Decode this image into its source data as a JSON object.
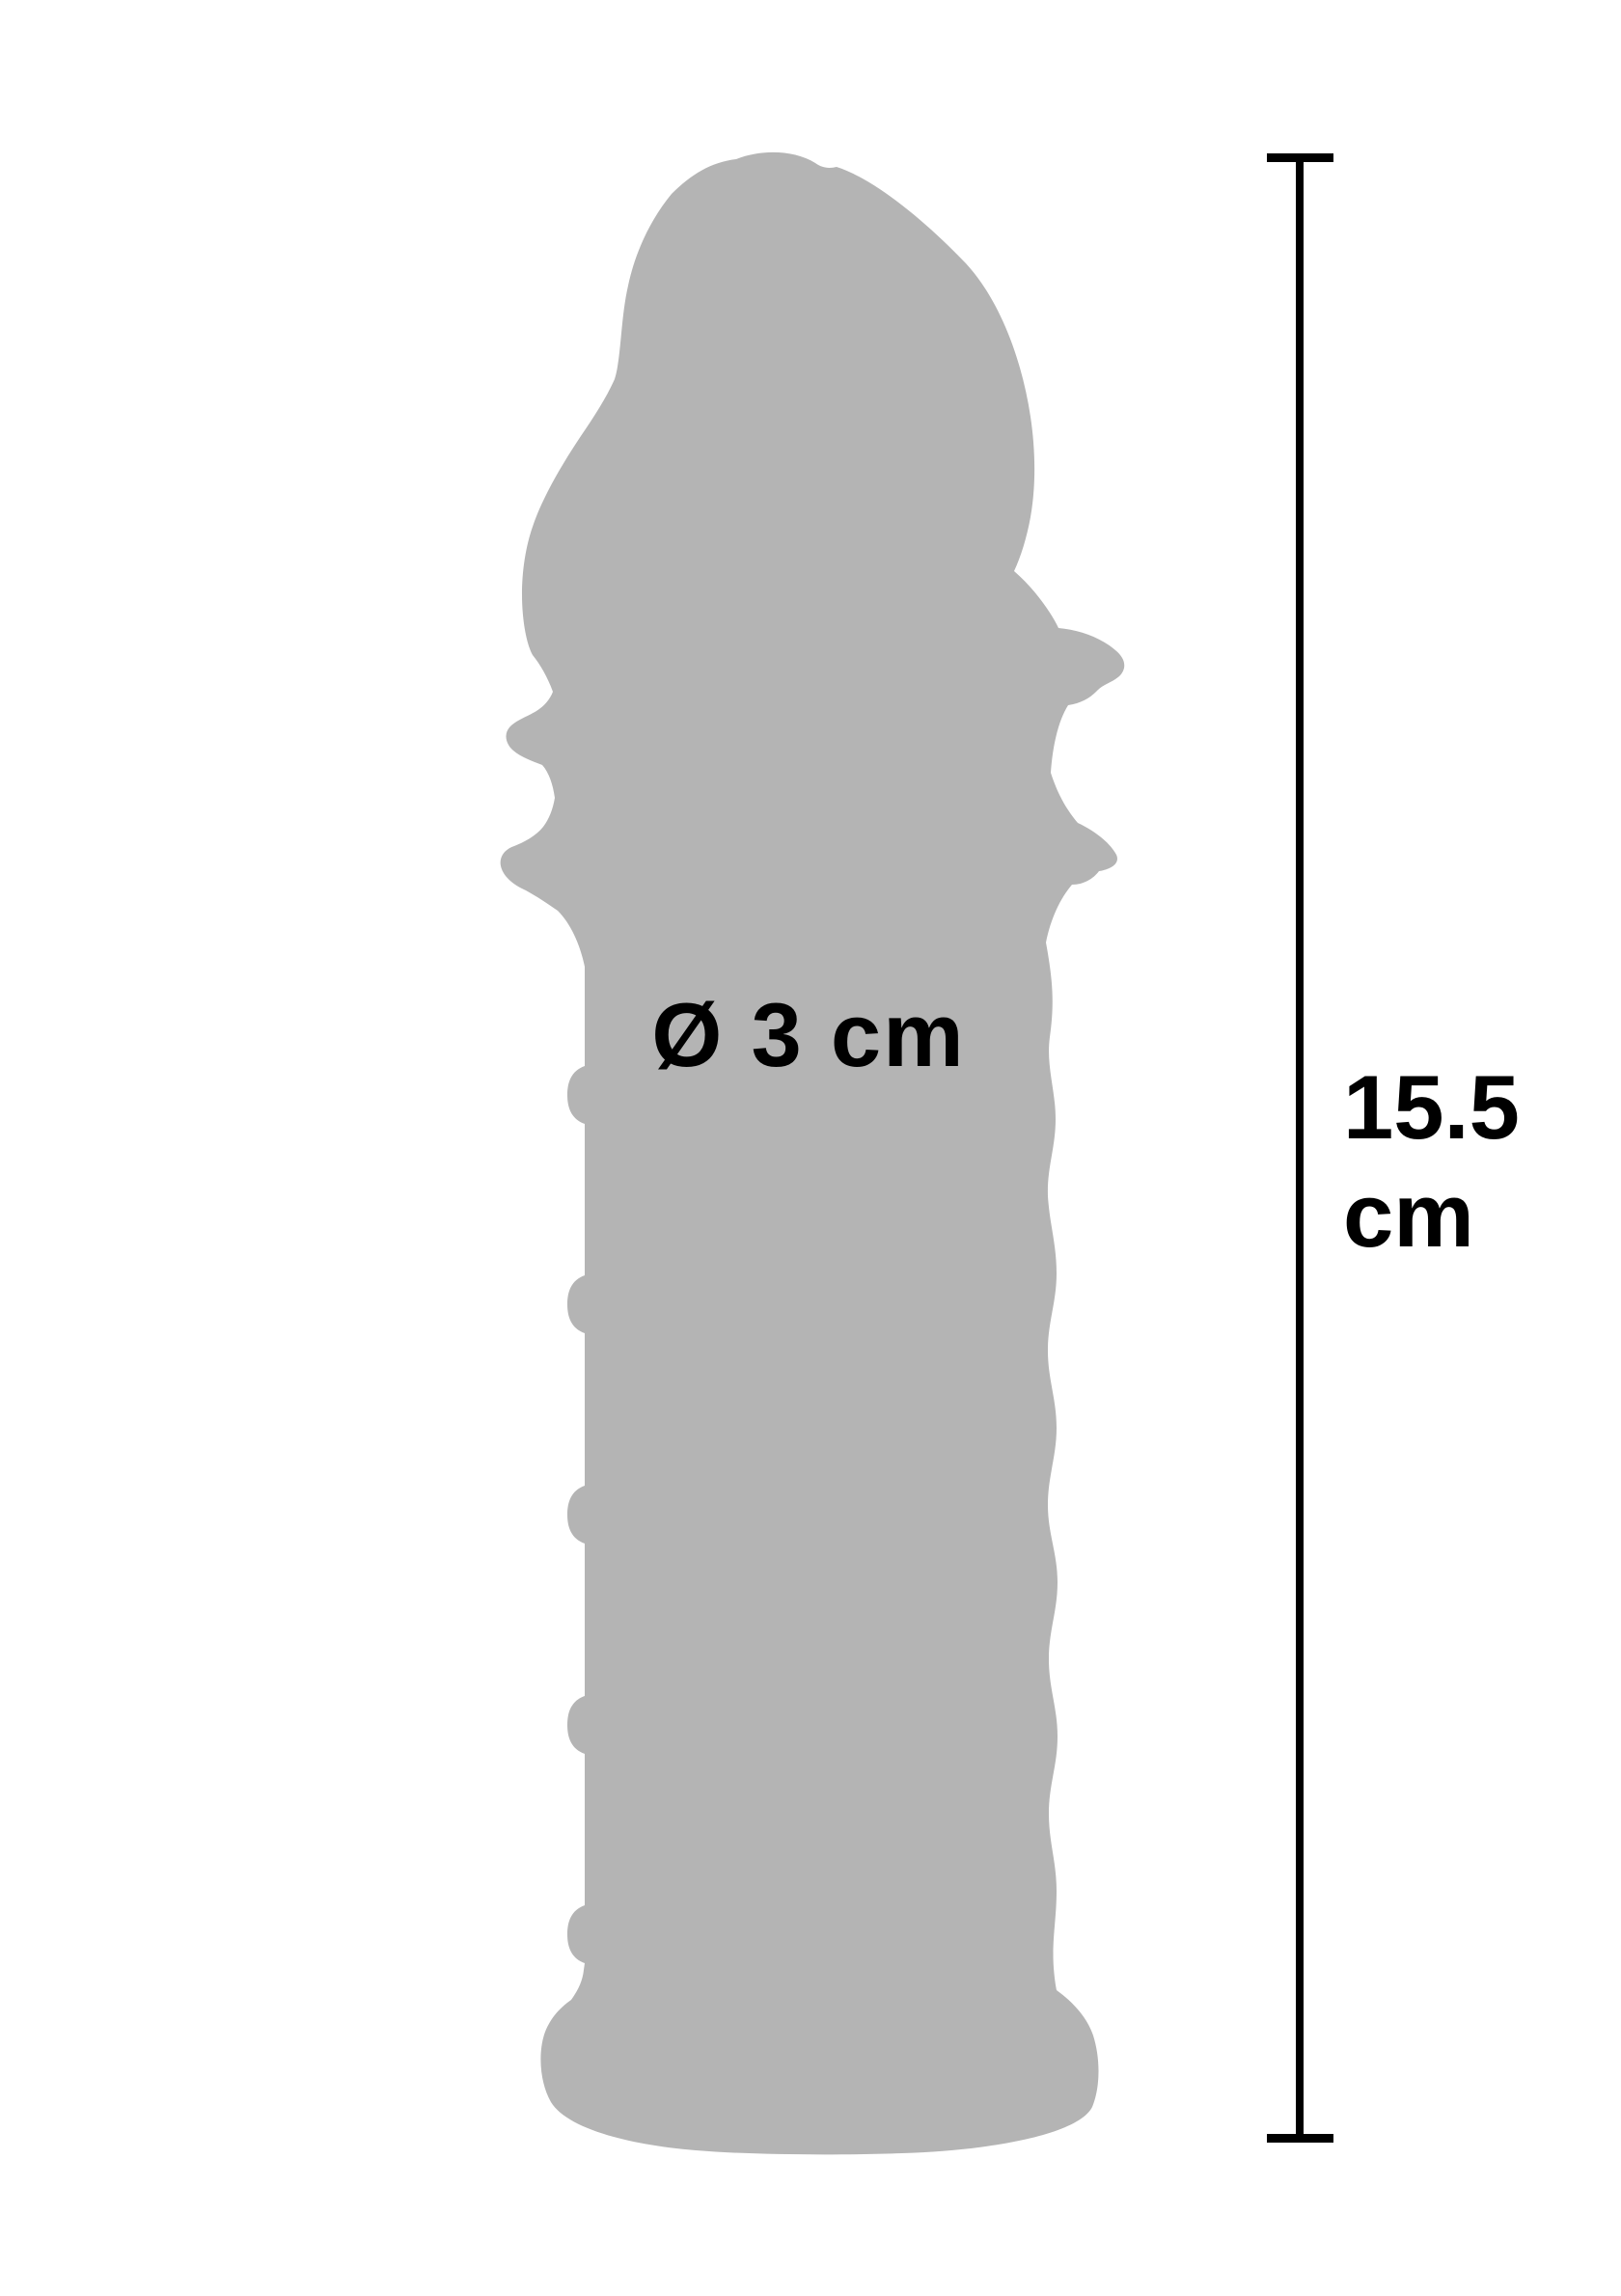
{
  "colors": {
    "background": "#ffffff",
    "silhouette": "#b4b4b4",
    "ink": "#000000"
  },
  "labels": {
    "diameter": {
      "text": "Ø 3 cm"
    },
    "length": {
      "value": "15.5",
      "unit": "cm"
    }
  }
}
